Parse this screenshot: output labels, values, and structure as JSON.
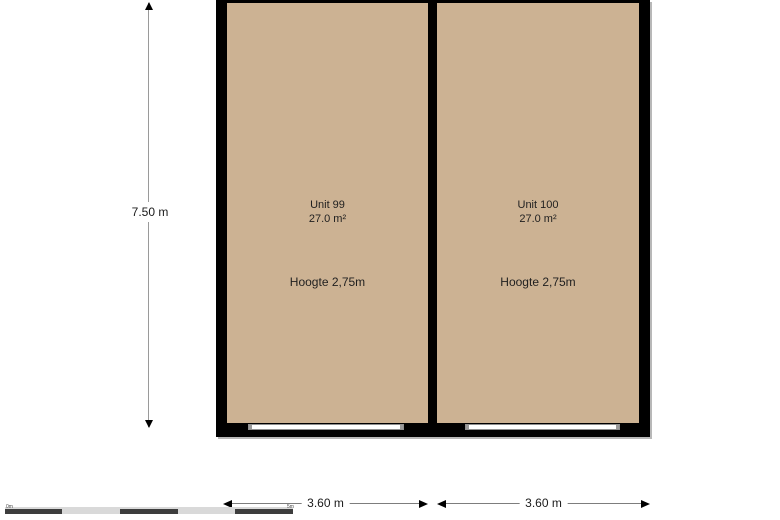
{
  "floor_plan": {
    "units": [
      {
        "name": "Unit 99",
        "area": "27.0 m²",
        "height_label": "Hoogte 2,75m",
        "width_dim": "3.60 m"
      },
      {
        "name": "Unit 100",
        "area": "27.0 m²",
        "height_label": "Hoogte 2,75m",
        "width_dim": "3.60 m"
      }
    ],
    "height_dim": "7.50 m",
    "scale_bar": {
      "start_label": "0m",
      "end_label": "5m"
    },
    "colors": {
      "floor": "#ccb293",
      "wall": "#000000",
      "dimension_line": "#9a9a9a",
      "shadow": "#b8b8b8"
    }
  }
}
